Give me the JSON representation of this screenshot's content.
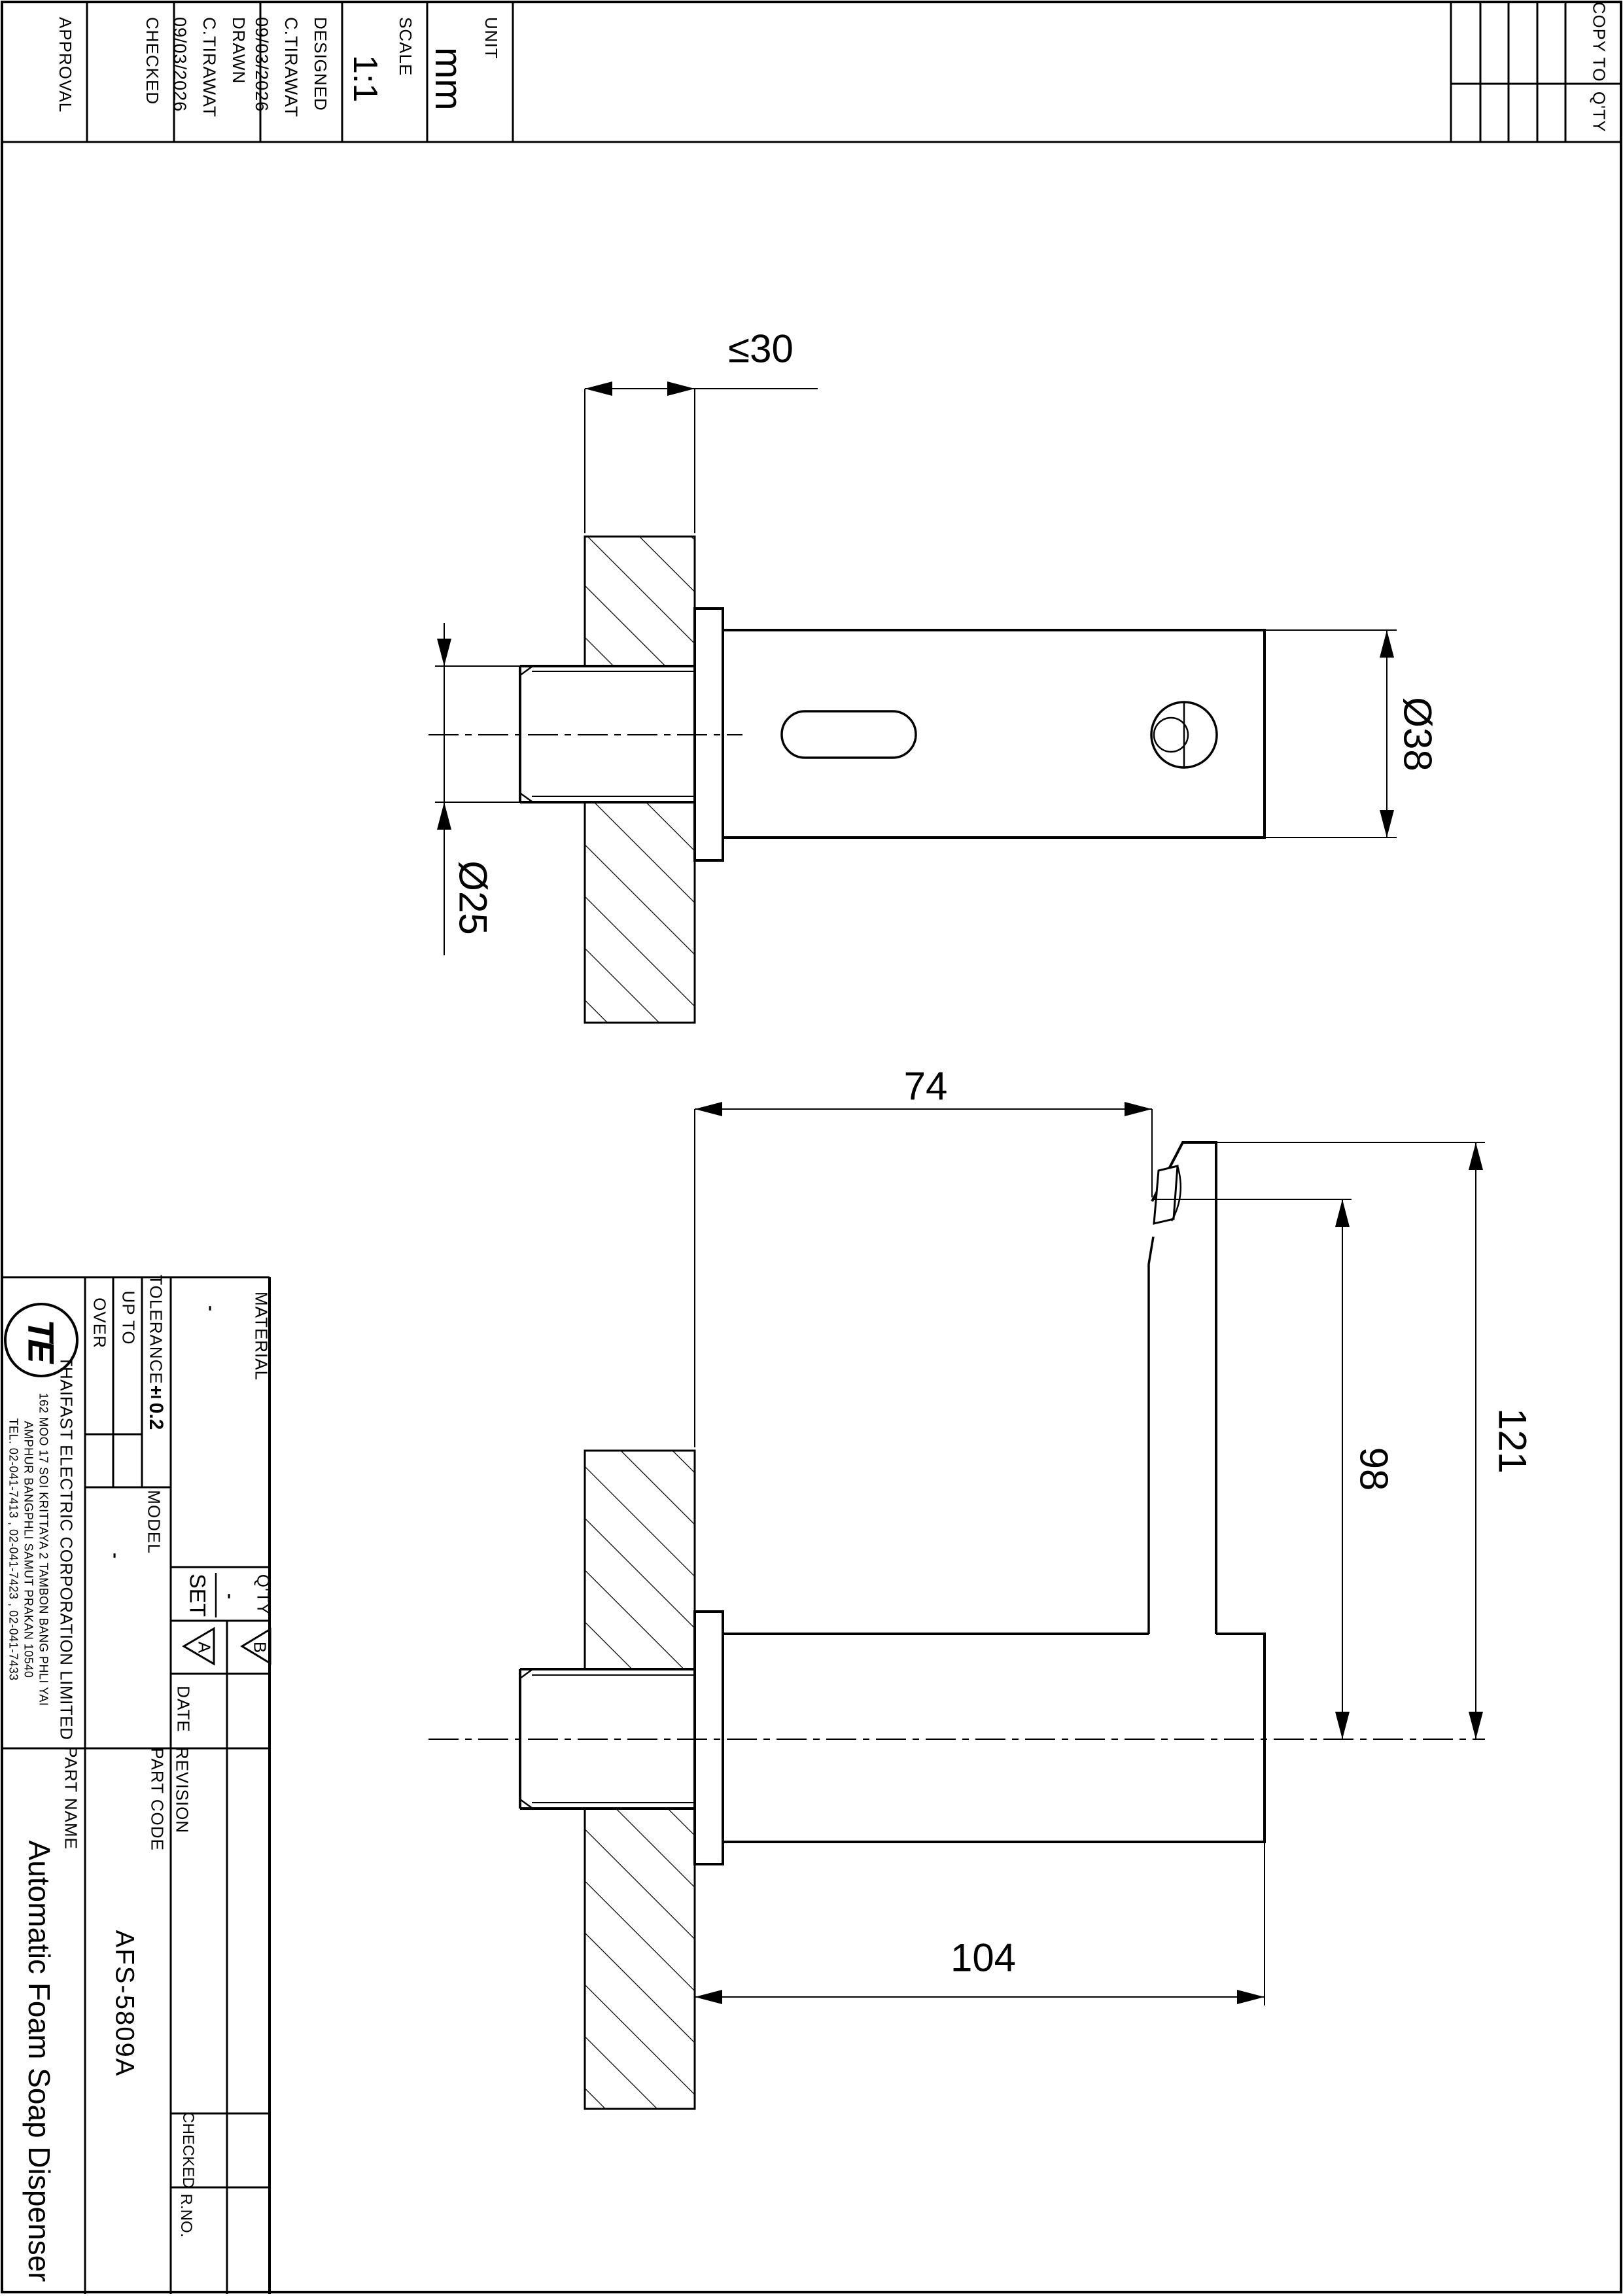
{
  "top_left_table": {
    "cells": [
      {
        "label": "APPROVAL",
        "values": []
      },
      {
        "label": "CHECKED",
        "values": []
      },
      {
        "label": "DRAWN",
        "values": [
          "C.TIRAWAT",
          "09/03/2026"
        ]
      },
      {
        "label": "DESIGNED",
        "values": [
          "C.TIRAWAT",
          "09/03/2026"
        ]
      },
      {
        "label": "SCALE",
        "big_value": "1:1"
      },
      {
        "label": "UNIT",
        "big_value": "mm"
      }
    ]
  },
  "copy_table": {
    "copy_to": "COPY TO",
    "qty": "Q'TY"
  },
  "title_block": {
    "company": {
      "logo_text": "TE",
      "name": "THAIFAST ELECTRIC CORPORATION LIMITED",
      "address1": "162  MOO  17  SOI  KRITTAYA  2  TAMBON  BANG  PHLI  YAI",
      "address2": "AMPHUR  BANGPHLI  SAMUT  PRAKAN  10540",
      "address3": "TEL.  02-041-7413 ,  02-041-7423 ,  02-041-7433"
    },
    "tolerance": {
      "label": "TOLERANCE",
      "value": "±0.2",
      "up_to": "UP TO",
      "over": "OVER"
    },
    "material": {
      "label": "MATERIAL",
      "value": "-"
    },
    "model": {
      "label": "MODEL",
      "value": "-"
    },
    "set": {
      "label": "SET",
      "value": "-"
    },
    "qty_label": "Q'TY",
    "finish_symbols": [
      "A",
      "B"
    ],
    "date_label": "DATE",
    "revision_label": "REVISION",
    "part_name": {
      "label": "PART NAME",
      "value": "Automatic Foam Soap Dispenser"
    },
    "part_code": {
      "label": "PART CODE",
      "value": "AFS-5809A"
    },
    "checked_label": "CHECKED",
    "rno_label": "R.NO."
  },
  "dimensions": {
    "wall_max": "≤30",
    "stem_dia": "Ø25",
    "body_dia": "Ø38",
    "spout_offset": "74",
    "nozzle_height": "98",
    "total_height": "121",
    "body_length": "104"
  }
}
